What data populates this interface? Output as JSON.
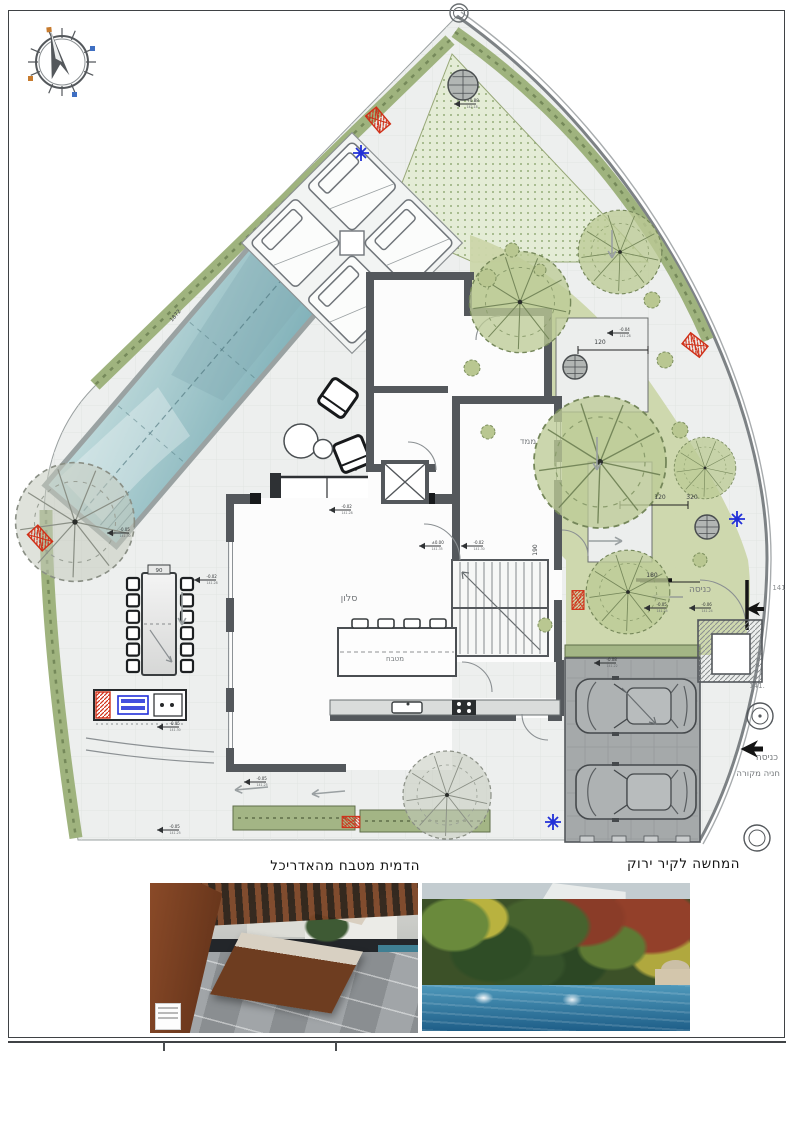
{
  "plan": {
    "rooms": {
      "living": "סלון",
      "kitchen": "מטבח",
      "safe_room": "ממד"
    },
    "labels": {
      "entrance_top": "כניסה",
      "entrance_side": "כניסה",
      "covered_parking": "חניה מקורה"
    },
    "dims": {
      "table": "90",
      "sofa": "230",
      "terrace_a": "120",
      "terrace_b": "120",
      "terrace_c": "320",
      "gate": "180",
      "path": "190",
      "boundary": "1872",
      "elev_a": "141.",
      "elev_b": "141"
    },
    "levels": [
      {
        "v": "-0.05",
        "d": "141.30"
      },
      {
        "v": "-0.02",
        "d": "141.28"
      },
      {
        "v": "+0.88",
        "d": "142.18"
      },
      {
        "v": "-0.02",
        "d": "141.28"
      },
      {
        "v": "±0.00",
        "d": "141.35"
      },
      {
        "v": "-0.02",
        "d": "141.30"
      },
      {
        "v": "-0.04",
        "d": "141.28"
      },
      {
        "v": "-0.05",
        "d": "141.25"
      },
      {
        "v": "-0.08",
        "d": "141.22"
      },
      {
        "v": "-0.05",
        "d": "141.25"
      },
      {
        "v": "-0.05",
        "d": "141.25"
      },
      {
        "v": "-0.05",
        "d": "141.30"
      },
      {
        "v": "-0.06",
        "d": "141.24"
      }
    ]
  },
  "photos": {
    "left_caption": "הדמית מטבח מהאדריכל",
    "right_caption": "המחשה לקיר ירוק"
  },
  "colors": {
    "lawn": "#e4ecd6",
    "garden": "#ccd6aa",
    "hedge": "#9fb37e",
    "pool": "#8fc0c6",
    "marker_red": "#d03018",
    "marker_blue": "#2230d8",
    "garage": "#a5a9aa"
  }
}
